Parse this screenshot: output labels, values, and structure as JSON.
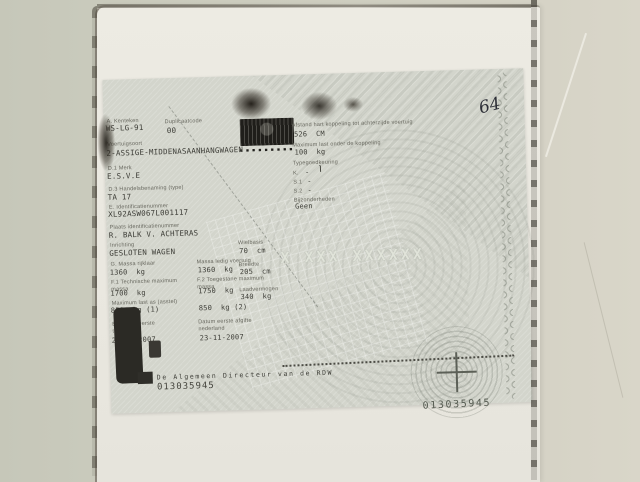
{
  "scene": {
    "handwritten_mark": "64"
  },
  "document": {
    "title_fields": [
      {
        "label": "A. Kenteken",
        "value": "WS-LG-91"
      },
      {
        "label": "Duplicaatcode",
        "value": "00"
      },
      {
        "label": "Voertuigsoort",
        "value": "2-ASSIGE-MIDDENASAANHANGWAGEN"
      },
      {
        "label": "D.1 Merk",
        "value": "E.S.V.E"
      },
      {
        "label": "D.3 Handelsbenaming (type)",
        "value": "TA 17"
      },
      {
        "label": "E. Identificatienummer",
        "value": "XL92ASW067L001117"
      },
      {
        "label": "Plaats identificatienummer",
        "value": "R. BALK V. ACHTERAS"
      },
      {
        "label": "Inrichting",
        "value": "GESLOTEN WAGEN"
      }
    ],
    "stamp_dots": "▪▪▪▪▪▪▪▪▪",
    "mass_table": {
      "rows": [
        {
          "label1": "G. Massa rijklaar",
          "value1": "1360  kg",
          "label2": "Massa ledig voertuig",
          "value2": "1360  kg"
        },
        {
          "label1": "F.1 Technische maximum massa",
          "value1": "1700  kg",
          "label2": "F.2 Toegestane maximum massa",
          "value2": "1750  kg"
        },
        {
          "label1": "Maximum last as (asstel)",
          "value1": "850  kg (1)",
          "label2": "",
          "value2": "850  kg (2)"
        },
        {
          "label1": "B. Datum eerste toelating",
          "value1": "23-11-2007",
          "label2": "Datum eerste afgifte nederland",
          "value2": "23-11-2007"
        }
      ],
      "dims": [
        {
          "label": "Wielbasis",
          "value": "70  cm"
        },
        {
          "label": "Breedte",
          "value": "205  cm"
        },
        {
          "label": "Laadvermogen",
          "value": "340  kg"
        }
      ]
    },
    "right_fields": [
      {
        "label": "Afstand hart koppeling tot achterzijde voertuig",
        "value": "526  CM"
      },
      {
        "label": "Maximum last onder de koppeling",
        "value": "100  kg"
      },
      {
        "label": "Typegoedkeuring",
        "value": ""
      },
      {
        "label": "K.",
        "value": "-"
      },
      {
        "label": "S.1",
        "value": "-"
      },
      {
        "label": "S.2",
        "value": "-"
      },
      {
        "label": "Bijzonderheden",
        "value": "Geen"
      }
    ],
    "watermark": "X XXX XXXXXX",
    "footer": {
      "signature": "De Algemeen Directeur van de RDW",
      "number_left": "013035945",
      "number_right": "013035945"
    }
  }
}
